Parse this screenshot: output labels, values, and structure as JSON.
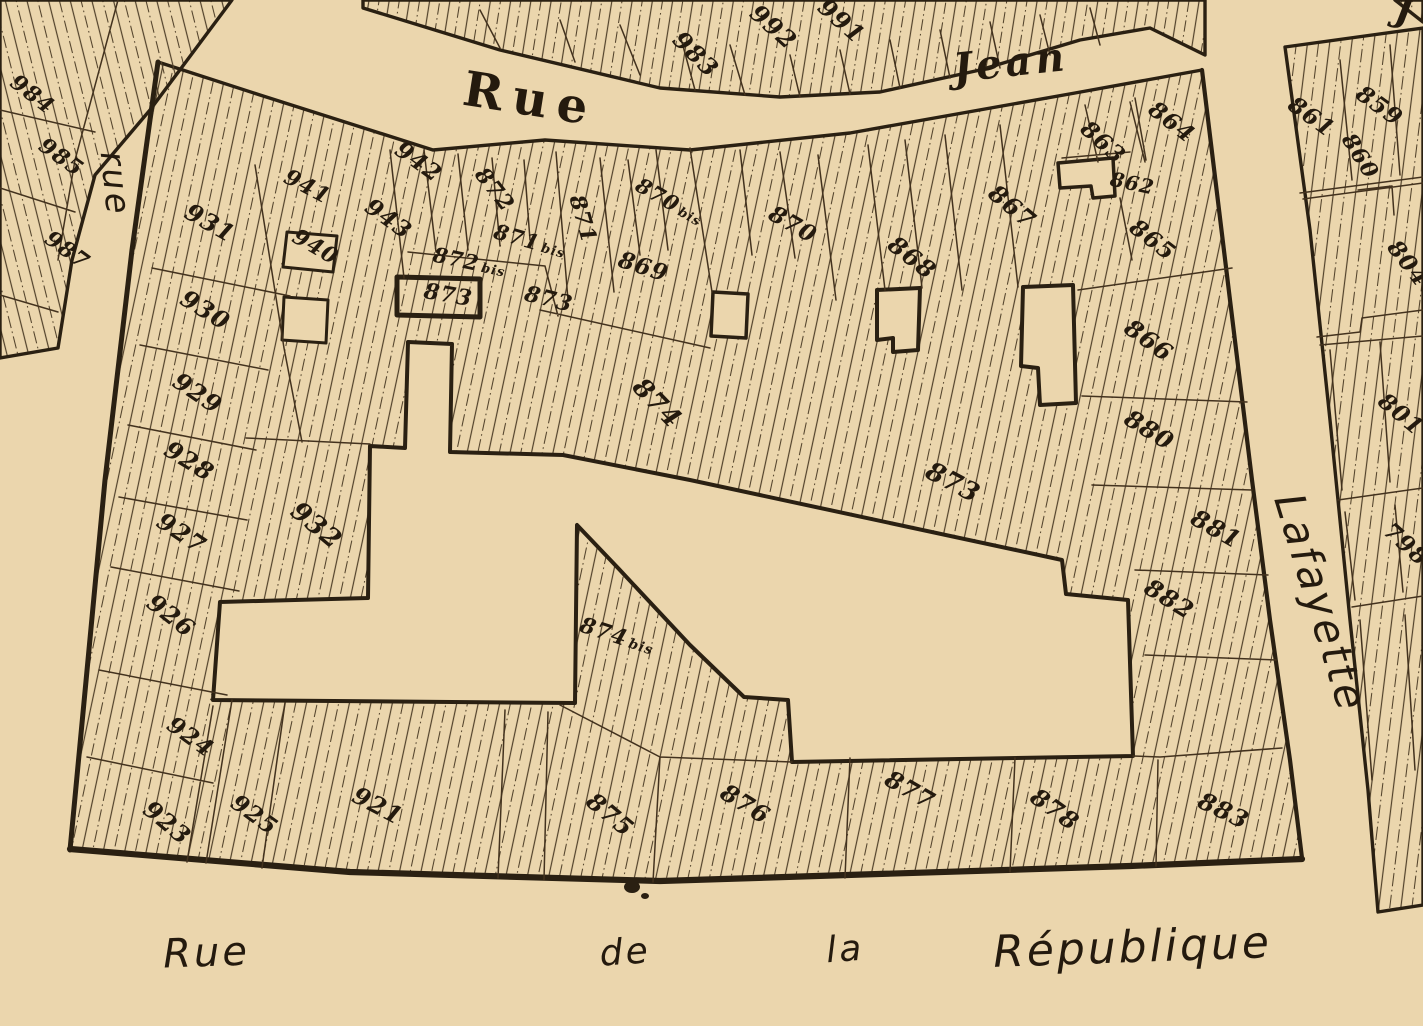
{
  "palette": {
    "paper": "#ebd6ad",
    "ink": "#241a0e",
    "ink_strong": "#2a2012",
    "thin_line": "#43321e",
    "hatch_line": "#51412a"
  },
  "streets": [
    {
      "id": "rue-jean-west",
      "name": "Rue",
      "x": 528,
      "y": 115,
      "r": 9,
      "s": 48,
      "cls": "street-print"
    },
    {
      "id": "rue-jean-east",
      "name": "Jean",
      "x": 1012,
      "y": 76,
      "r": -6,
      "s": 40,
      "cls": "street-italic-serif"
    },
    {
      "id": "rue-left",
      "name": "rue",
      "x": 104,
      "y": 185,
      "r": 84,
      "s": 34,
      "cls": "street-cursive"
    },
    {
      "id": "rue-lafayette",
      "name": "Lafayette",
      "x": 1307,
      "y": 607,
      "r": 73,
      "s": 42,
      "cls": "street-cursive"
    },
    {
      "id": "republique-rue",
      "name": "Rue",
      "x": 207,
      "y": 966,
      "r": -2,
      "s": 40,
      "cls": "street-cursive"
    },
    {
      "id": "republique-de",
      "name": "de",
      "x": 626,
      "y": 964,
      "r": -4,
      "s": 36,
      "cls": "street-cursive"
    },
    {
      "id": "republique-la",
      "name": "la",
      "x": 846,
      "y": 961,
      "r": -4,
      "s": 36,
      "cls": "street-cursive"
    },
    {
      "id": "republique-name",
      "name": "République",
      "x": 1133,
      "y": 962,
      "r": -2,
      "s": 44,
      "cls": "street-cursive"
    },
    {
      "id": "jean-east-fragment",
      "name": "J",
      "x": 1404,
      "y": 22,
      "r": 10,
      "s": 36,
      "cls": "street-italic-serif"
    }
  ],
  "parcels": [
    {
      "n": "984",
      "x": 28,
      "y": 100,
      "r": 38,
      "s": 22
    },
    {
      "n": "985",
      "x": 57,
      "y": 163,
      "r": 36,
      "s": 22
    },
    {
      "n": "987",
      "x": 63,
      "y": 256,
      "r": 36,
      "s": 22
    },
    {
      "n": "983",
      "x": 690,
      "y": 60,
      "r": 45,
      "s": 24
    },
    {
      "n": "992",
      "x": 768,
      "y": 33,
      "r": 42,
      "s": 24
    },
    {
      "n": "991",
      "x": 836,
      "y": 27,
      "r": 42,
      "s": 24
    },
    {
      "n": "859",
      "x": 1375,
      "y": 112,
      "r": 36,
      "s": 23
    },
    {
      "n": "860",
      "x": 1354,
      "y": 160,
      "r": 58,
      "s": 22
    },
    {
      "n": "861",
      "x": 1307,
      "y": 123,
      "r": 36,
      "s": 23
    },
    {
      "n": "804",
      "x": 1402,
      "y": 268,
      "r": 52,
      "s": 23
    },
    {
      "n": "801",
      "x": 1396,
      "y": 420,
      "r": 40,
      "s": 23
    },
    {
      "n": "798",
      "x": 1401,
      "y": 550,
      "r": 42,
      "s": 23
    },
    {
      "n": "931",
      "x": 206,
      "y": 230,
      "r": 30,
      "s": 24
    },
    {
      "n": "930",
      "x": 201,
      "y": 317,
      "r": 32,
      "s": 24
    },
    {
      "n": "929",
      "x": 193,
      "y": 400,
      "r": 34,
      "s": 24
    },
    {
      "n": "928",
      "x": 185,
      "y": 468,
      "r": 32,
      "s": 24
    },
    {
      "n": "927",
      "x": 177,
      "y": 540,
      "r": 34,
      "s": 24
    },
    {
      "n": "926",
      "x": 166,
      "y": 622,
      "r": 38,
      "s": 24
    },
    {
      "n": "924",
      "x": 186,
      "y": 743,
      "r": 36,
      "s": 23
    },
    {
      "n": "923",
      "x": 162,
      "y": 829,
      "r": 40,
      "s": 24
    },
    {
      "n": "925",
      "x": 250,
      "y": 821,
      "r": 36,
      "s": 23
    },
    {
      "n": "921",
      "x": 374,
      "y": 813,
      "r": 28,
      "s": 24
    },
    {
      "n": "932",
      "x": 311,
      "y": 532,
      "r": 40,
      "s": 26
    },
    {
      "n": "941",
      "x": 304,
      "y": 193,
      "r": 28,
      "s": 22
    },
    {
      "n": "940",
      "x": 312,
      "y": 253,
      "r": 30,
      "s": 22
    },
    {
      "n": "943",
      "x": 384,
      "y": 225,
      "r": 36,
      "s": 23
    },
    {
      "n": "942",
      "x": 414,
      "y": 168,
      "r": 36,
      "s": 23
    },
    {
      "n": "872",
      "x": 489,
      "y": 194,
      "r": 52,
      "s": 22
    },
    {
      "n": "871",
      "x": 576,
      "y": 221,
      "r": 74,
      "s": 22
    },
    {
      "n": "871",
      "suffix": "bis",
      "x": 528,
      "y": 248,
      "r": 16,
      "s": 21
    },
    {
      "n": "872",
      "suffix": "bis",
      "x": 468,
      "y": 269,
      "r": 12,
      "s": 21
    },
    {
      "n": "873",
      "x": 447,
      "y": 302,
      "r": 10,
      "s": 22
    },
    {
      "n": "873",
      "x": 547,
      "y": 306,
      "r": 14,
      "s": 22
    },
    {
      "n": "869",
      "x": 641,
      "y": 274,
      "r": 18,
      "s": 23
    },
    {
      "n": "870",
      "suffix": "bis",
      "x": 666,
      "y": 208,
      "r": 30,
      "s": 21
    },
    {
      "n": "870",
      "x": 789,
      "y": 231,
      "r": 30,
      "s": 23
    },
    {
      "n": "868",
      "x": 907,
      "y": 264,
      "r": 38,
      "s": 24
    },
    {
      "n": "867",
      "x": 1007,
      "y": 213,
      "r": 40,
      "s": 24
    },
    {
      "n": "862",
      "x": 1131,
      "y": 190,
      "r": 12,
      "s": 20
    },
    {
      "n": "863",
      "x": 1098,
      "y": 148,
      "r": 42,
      "s": 23
    },
    {
      "n": "864",
      "x": 1167,
      "y": 128,
      "r": 38,
      "s": 23
    },
    {
      "n": "865",
      "x": 1148,
      "y": 246,
      "r": 38,
      "s": 23
    },
    {
      "n": "866",
      "x": 1144,
      "y": 347,
      "r": 36,
      "s": 24
    },
    {
      "n": "880",
      "x": 1145,
      "y": 437,
      "r": 32,
      "s": 24
    },
    {
      "n": "874",
      "x": 651,
      "y": 409,
      "r": 46,
      "s": 26
    },
    {
      "n": "874",
      "suffix": "bis",
      "x": 615,
      "y": 643,
      "r": 18,
      "s": 22
    },
    {
      "n": "873",
      "x": 949,
      "y": 490,
      "r": 28,
      "s": 26
    },
    {
      "n": "881",
      "x": 1212,
      "y": 536,
      "r": 30,
      "s": 24
    },
    {
      "n": "882",
      "x": 1165,
      "y": 606,
      "r": 32,
      "s": 24
    },
    {
      "n": "875",
      "x": 605,
      "y": 821,
      "r": 40,
      "s": 24
    },
    {
      "n": "876",
      "x": 741,
      "y": 811,
      "r": 32,
      "s": 24
    },
    {
      "n": "877",
      "x": 906,
      "y": 797,
      "r": 30,
      "s": 24
    },
    {
      "n": "878",
      "x": 1050,
      "y": 816,
      "r": 36,
      "s": 24
    },
    {
      "n": "883",
      "x": 1220,
      "y": 818,
      "r": 26,
      "s": 24
    }
  ]
}
